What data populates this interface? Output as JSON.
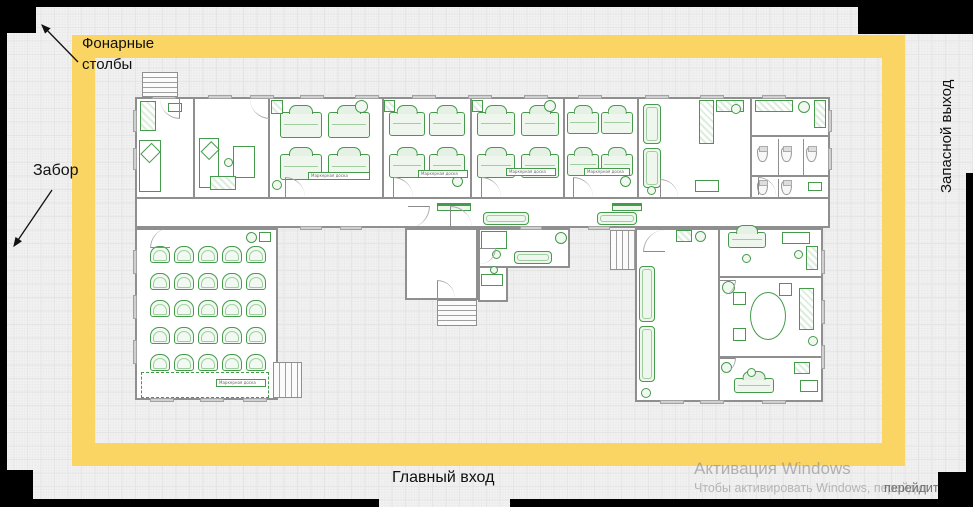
{
  "colors": {
    "frame_yellow": "#fbd563",
    "furniture_green": "#459a4b",
    "wall_grey": "#8f8f8f",
    "boundary_black": "#000000",
    "watermark_grey": "#7d7d7d"
  },
  "annotations": {
    "lamp_posts_line1": "Фонарные",
    "lamp_posts_line2": "столбы",
    "fence": "Забор",
    "emergency_exit": "Запасной выход",
    "main_entrance": "Главный вход"
  },
  "watermark": {
    "title": "Активация Windows",
    "subtitle": "Чтобы активировать Windows, перейдит",
    "subtitle_tail": "перейдит"
  },
  "plan": {
    "board_label": "Маркерная доска",
    "rooms": [
      [
        135,
        97,
        695,
        131
      ],
      [
        135,
        228,
        143,
        172
      ],
      [
        405,
        228,
        73,
        72
      ],
      [
        478,
        228,
        92,
        40
      ],
      [
        478,
        266,
        30,
        36
      ],
      [
        635,
        228,
        188,
        174
      ]
    ],
    "walls": [
      [
        193,
        97,
        2,
        100
      ],
      [
        268,
        97,
        2,
        100
      ],
      [
        382,
        97,
        2,
        100
      ],
      [
        470,
        97,
        2,
        100
      ],
      [
        563,
        97,
        2,
        100
      ],
      [
        637,
        97,
        2,
        100
      ],
      [
        750,
        97,
        2,
        100
      ],
      [
        135,
        197,
        695,
        2
      ],
      [
        718,
        228,
        2,
        172
      ],
      [
        718,
        276,
        105,
        2
      ],
      [
        718,
        356,
        105,
        2
      ],
      [
        752,
        135,
        78,
        2
      ],
      [
        752,
        175,
        78,
        2
      ],
      [
        778,
        139,
        1,
        36
      ],
      [
        803,
        139,
        1,
        36
      ],
      [
        778,
        179,
        1,
        18
      ]
    ],
    "windows": [
      [
        152,
        95,
        24,
        4
      ],
      [
        208,
        95,
        24,
        4
      ],
      [
        250,
        95,
        24,
        4
      ],
      [
        300,
        95,
        24,
        4
      ],
      [
        355,
        95,
        24,
        4
      ],
      [
        412,
        95,
        24,
        4
      ],
      [
        468,
        95,
        24,
        4
      ],
      [
        524,
        95,
        24,
        4
      ],
      [
        578,
        95,
        24,
        4
      ],
      [
        645,
        95,
        24,
        4
      ],
      [
        700,
        95,
        24,
        4
      ],
      [
        762,
        95,
        24,
        4
      ],
      [
        133,
        110,
        4,
        22
      ],
      [
        133,
        148,
        4,
        22
      ],
      [
        828,
        110,
        4,
        22
      ],
      [
        828,
        148,
        4,
        22
      ],
      [
        133,
        250,
        4,
        24
      ],
      [
        133,
        295,
        4,
        24
      ],
      [
        133,
        340,
        4,
        24
      ],
      [
        150,
        398,
        24,
        4
      ],
      [
        200,
        398,
        24,
        4
      ],
      [
        243,
        398,
        24,
        4
      ],
      [
        821,
        250,
        4,
        24
      ],
      [
        821,
        300,
        4,
        24
      ],
      [
        821,
        345,
        4,
        24
      ],
      [
        660,
        400,
        24,
        4
      ],
      [
        700,
        400,
        24,
        4
      ],
      [
        762,
        400,
        24,
        4
      ],
      [
        300,
        226,
        22,
        4
      ],
      [
        340,
        226,
        22,
        4
      ],
      [
        520,
        226,
        22,
        4
      ],
      [
        588,
        226,
        22,
        4
      ]
    ],
    "stairs": [
      [
        142,
        72,
        36,
        25,
        "h"
      ],
      [
        437,
        300,
        40,
        26,
        "h"
      ],
      [
        273,
        362,
        29,
        36,
        "v"
      ],
      [
        610,
        230,
        26,
        40,
        "v"
      ]
    ],
    "doors": [
      [
        285,
        177,
        20,
        0
      ],
      [
        393,
        177,
        20,
        0
      ],
      [
        481,
        177,
        20,
        0
      ],
      [
        573,
        177,
        20,
        0
      ],
      [
        660,
        179,
        18,
        0
      ],
      [
        758,
        177,
        18,
        0
      ],
      [
        160,
        99,
        20,
        180
      ],
      [
        250,
        99,
        20,
        180
      ],
      [
        408,
        206,
        22,
        90
      ],
      [
        450,
        206,
        22,
        0
      ],
      [
        437,
        280,
        18,
        0
      ],
      [
        480,
        248,
        16,
        90
      ],
      [
        643,
        230,
        22,
        270
      ],
      [
        720,
        280,
        16,
        90
      ],
      [
        720,
        358,
        16,
        90
      ],
      [
        150,
        228,
        20,
        270
      ]
    ],
    "furniture": [
      [
        "counter",
        140,
        101,
        16,
        30
      ],
      [
        "bed",
        139,
        140,
        22,
        52
      ],
      [
        "table",
        168,
        103,
        14,
        9
      ],
      [
        "bed",
        199,
        138,
        20,
        50
      ],
      [
        "table",
        233,
        146,
        22,
        32
      ],
      [
        "circle",
        224,
        158,
        9,
        9
      ],
      [
        "counter",
        210,
        176,
        26,
        14
      ],
      [
        "desk",
        280,
        112,
        42,
        26
      ],
      [
        "desk",
        328,
        112,
        42,
        26
      ],
      [
        "desk",
        280,
        154,
        42,
        26
      ],
      [
        "desk",
        328,
        154,
        42,
        26
      ],
      [
        "counter",
        271,
        100,
        12,
        14
      ],
      [
        "circle",
        355,
        100,
        13,
        13
      ],
      [
        "circle",
        272,
        180,
        10,
        10
      ],
      [
        "desk",
        389,
        112,
        36,
        24
      ],
      [
        "desk",
        429,
        112,
        36,
        24
      ],
      [
        "desk",
        389,
        154,
        36,
        24
      ],
      [
        "desk",
        429,
        154,
        36,
        24
      ],
      [
        "counter",
        384,
        100,
        11,
        12
      ],
      [
        "circle",
        452,
        176,
        11,
        11
      ],
      [
        "desk",
        477,
        112,
        38,
        24
      ],
      [
        "desk",
        521,
        112,
        38,
        24
      ],
      [
        "desk",
        477,
        154,
        38,
        24
      ],
      [
        "desk",
        521,
        154,
        38,
        24
      ],
      [
        "counter",
        472,
        100,
        11,
        12
      ],
      [
        "circle",
        544,
        100,
        12,
        12
      ],
      [
        "desk",
        567,
        112,
        32,
        22
      ],
      [
        "desk",
        601,
        112,
        32,
        22
      ],
      [
        "desk",
        567,
        154,
        32,
        22
      ],
      [
        "desk",
        601,
        154,
        32,
        22
      ],
      [
        "circle",
        620,
        176,
        11,
        11
      ],
      [
        "sofa",
        643,
        104,
        18,
        40
      ],
      [
        "sofa",
        643,
        148,
        18,
        40
      ],
      [
        "counter",
        699,
        100,
        15,
        44
      ],
      [
        "counter",
        716,
        100,
        28,
        12
      ],
      [
        "circle",
        731,
        104,
        10,
        10
      ],
      [
        "table",
        695,
        180,
        24,
        12
      ],
      [
        "circle",
        647,
        186,
        9,
        9
      ],
      [
        "counter",
        755,
        100,
        38,
        12
      ],
      [
        "circle",
        798,
        101,
        12,
        12
      ],
      [
        "counter",
        814,
        100,
        12,
        28
      ],
      [
        "toilet",
        757,
        146,
        11,
        16
      ],
      [
        "toilet",
        781,
        146,
        11,
        16
      ],
      [
        "toilet",
        806,
        146,
        11,
        16
      ],
      [
        "toilet",
        757,
        180,
        11,
        15
      ],
      [
        "toilet",
        781,
        180,
        11,
        15
      ],
      [
        "table",
        808,
        182,
        14,
        9
      ],
      [
        "bench",
        437,
        203,
        34,
        8
      ],
      [
        "bench",
        612,
        203,
        30,
        8
      ],
      [
        "sofa",
        483,
        212,
        46,
        13
      ],
      [
        "sofa",
        597,
        212,
        40,
        13
      ],
      [
        "chairgrid",
        150,
        246,
        5,
        5,
        24,
        27,
        20,
        17
      ],
      [
        "circle",
        246,
        232,
        11,
        11
      ],
      [
        "table",
        259,
        232,
        12,
        10
      ],
      [
        "board",
        141,
        372,
        128,
        26
      ],
      [
        "table",
        481,
        231,
        26,
        18
      ],
      [
        "circle",
        492,
        250,
        9,
        9
      ],
      [
        "sofa",
        514,
        251,
        38,
        13
      ],
      [
        "circle",
        555,
        232,
        12,
        12
      ],
      [
        "table",
        481,
        274,
        22,
        12
      ],
      [
        "circle",
        490,
        266,
        8,
        8
      ],
      [
        "sofa",
        639,
        266,
        16,
        56
      ],
      [
        "sofa",
        639,
        326,
        16,
        56
      ],
      [
        "circle",
        641,
        388,
        10,
        10
      ],
      [
        "counter",
        676,
        230,
        16,
        12
      ],
      [
        "circle",
        695,
        231,
        11,
        11
      ],
      [
        "desk",
        728,
        232,
        38,
        16
      ],
      [
        "circle",
        742,
        254,
        9,
        9
      ],
      [
        "table",
        782,
        232,
        28,
        12
      ],
      [
        "circle",
        794,
        250,
        9,
        9
      ],
      [
        "counter",
        806,
        246,
        12,
        24
      ],
      [
        "oval",
        750,
        292,
        36,
        48
      ],
      [
        "table",
        733,
        292,
        13,
        13
      ],
      [
        "table",
        733,
        328,
        13,
        13
      ],
      [
        "table",
        779,
        283,
        13,
        13
      ],
      [
        "circle",
        722,
        281,
        13,
        13
      ],
      [
        "counter",
        799,
        288,
        15,
        42
      ],
      [
        "circle",
        808,
        336,
        10,
        10
      ],
      [
        "desk",
        734,
        378,
        40,
        15
      ],
      [
        "circle",
        747,
        368,
        9,
        9
      ],
      [
        "counter",
        794,
        362,
        16,
        12
      ],
      [
        "circle",
        721,
        362,
        11,
        11
      ],
      [
        "table",
        800,
        380,
        18,
        12
      ]
    ],
    "labels": [
      [
        308,
        172,
        62
      ],
      [
        418,
        170,
        50
      ],
      [
        506,
        168,
        50
      ],
      [
        584,
        168,
        46
      ],
      [
        216,
        379,
        50
      ]
    ]
  }
}
